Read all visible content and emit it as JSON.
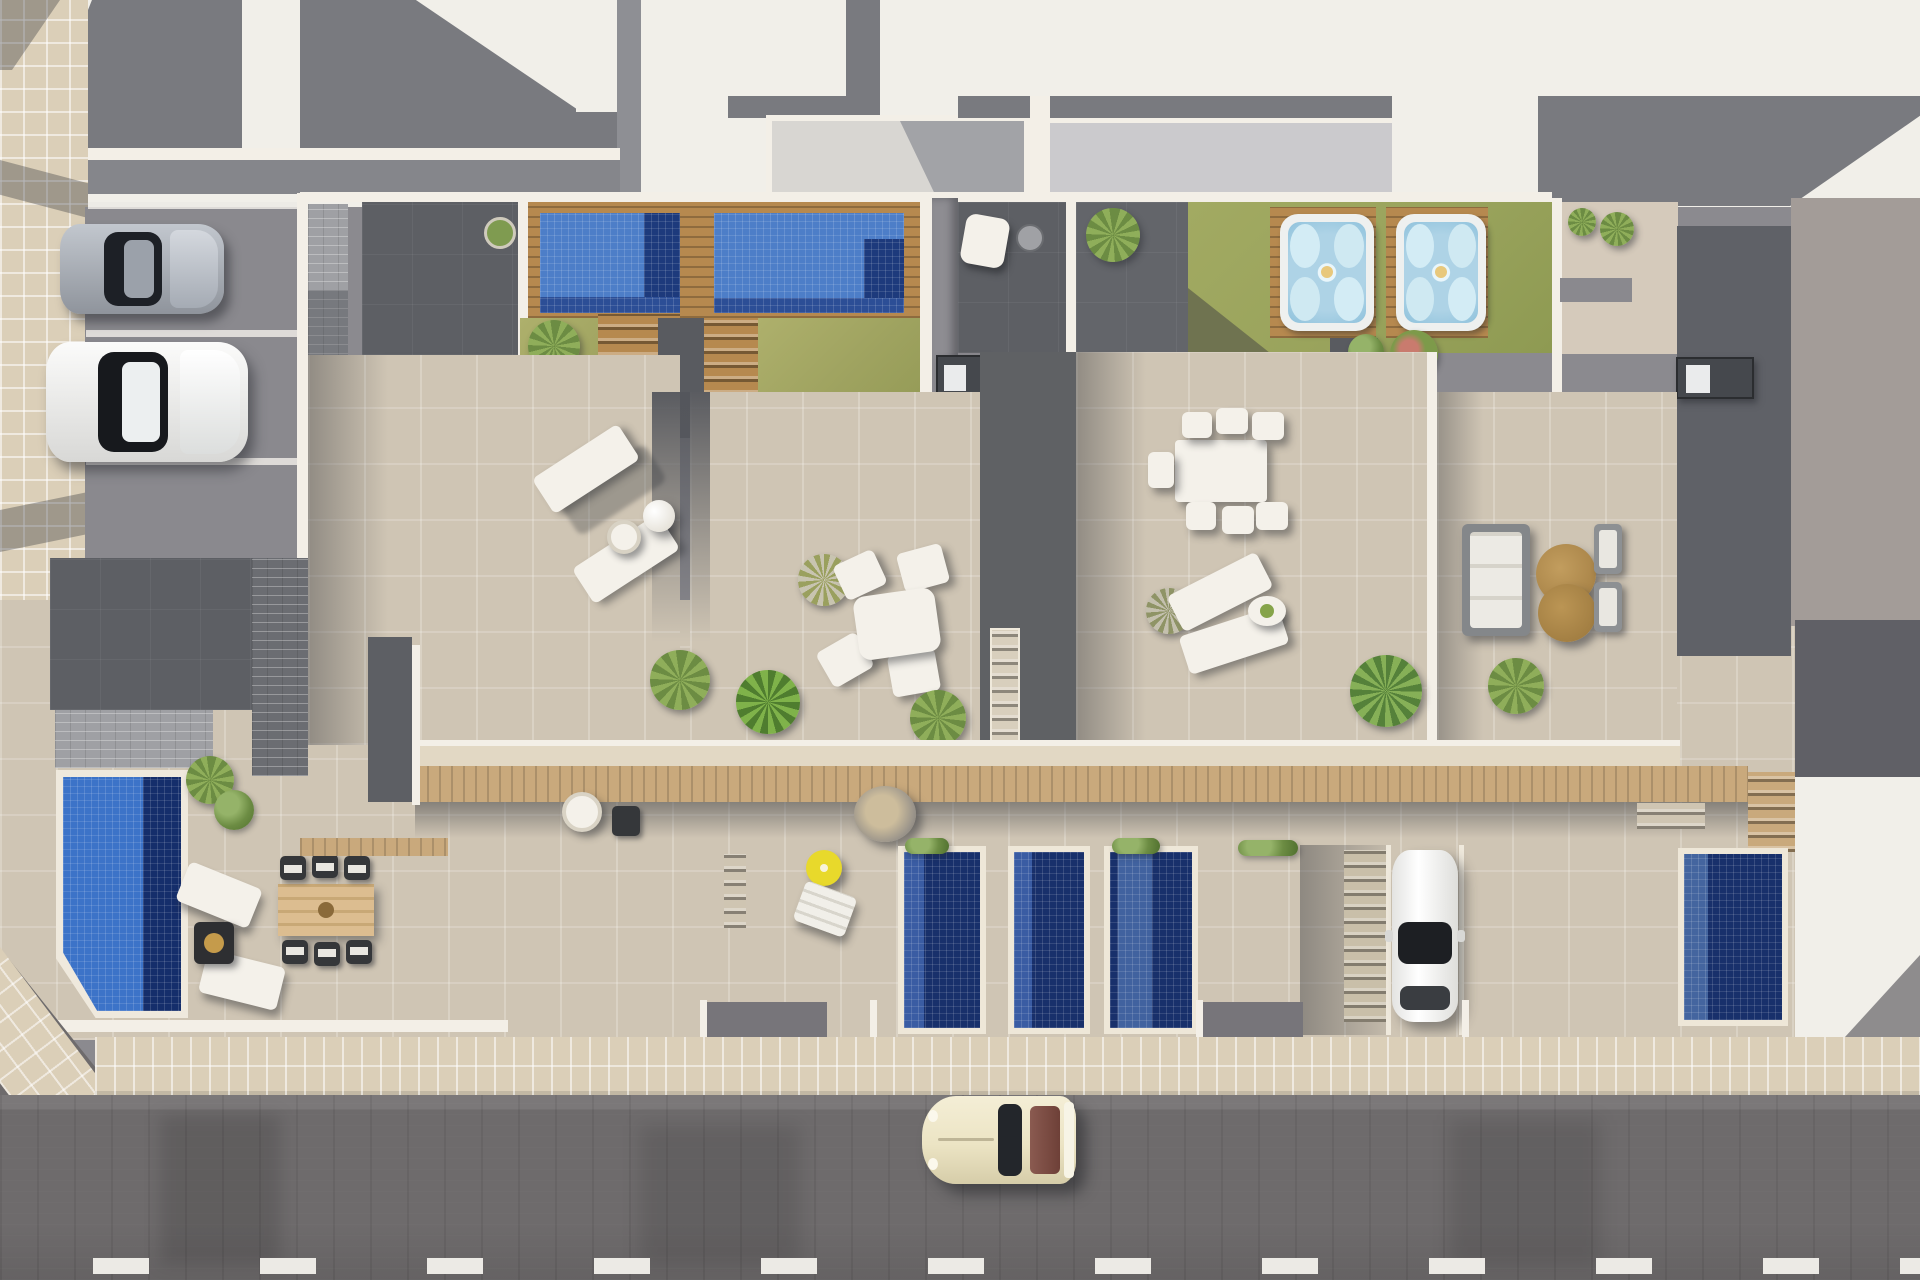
{
  "meta": {
    "type": "architectural-aerial-3d-render",
    "subject": "Top-down view of a row of modern townhouses with roof-terrace solariums, private pools, hot tubs, rear gardens, street-side parking and a road in the foreground",
    "canvas": {
      "width": 1920,
      "height": 1280
    },
    "visible_text": []
  },
  "palette": {
    "roof_white": "#f1efe9",
    "roof_shadow": "#797a7f",
    "panel_gray": "#d8d6d2",
    "concrete_mid": "#8b8a8f",
    "terrace_dark": "#5d5f64",
    "terrace_beige": "#cfc5b4",
    "wall_white": "#f3efe7",
    "band_beige": "#e2d8c4",
    "sidewalk_beige": "#dbcfb8",
    "street_gray": "#6e6b6c",
    "lane_white": "#eceae5",
    "pool_blue": "#4d7ec8",
    "pool_navy": "#1d3a7c",
    "pool_deep": "#18306b",
    "pool_bright": "#3c73c8",
    "lawn_green": "#a9ac68",
    "lawn_olive": "#99a35c",
    "wood": "#b6894f",
    "wood_light": "#c9a97c",
    "hot_tub_blue": "#aed3e6",
    "table_tan": "#b18c50",
    "parasol_yellow": "#e8d92b",
    "car_cream": "#ece4c4",
    "car_silver": "#a7aeb8",
    "car_white": "#f4f4f4",
    "plant_green": "#76984b"
  },
  "scene": {
    "roofs": {
      "upper_roof_count": 4,
      "shadow_shapes": "hard sun shadows cast to lower-left"
    },
    "roof_gardens": {
      "tiled_roof_pools": 2,
      "hot_tubs_on_wood_decks": 2,
      "lawns": 4,
      "dark_roof_patios": 3,
      "tree_planter_circle": 1,
      "outdoor_kitchen_counters": 7
    },
    "roof_terraces": [
      {
        "unit": 1,
        "furniture": [
          "sun-lounger",
          "sun-lounger",
          "side-table",
          "parasol-ball"
        ]
      },
      {
        "unit": 2,
        "furniture": [
          "dining-table",
          "chair",
          "chair",
          "chair",
          "chair",
          "fan-palm"
        ]
      },
      {
        "unit": 3,
        "furniture": [
          "dining-table",
          "six-chairs",
          "sun-lounger",
          "sun-lounger",
          "oval-table"
        ]
      },
      {
        "unit": 4,
        "furniture": [
          "garden-sofa",
          "round-coffee-table",
          "round-coffee-table",
          "armchair",
          "armchair"
        ]
      }
    ],
    "ground_level": {
      "narrow_plunge_pools": 4,
      "corner_garden_pool": 1,
      "yellow_parasol": 1,
      "hanging_chair": 1,
      "wood_pergola_walkway": true,
      "staircases": 5,
      "parked_white_car_driveway": 1,
      "corner_patio": [
        "sun-lounger",
        "sun-lounger",
        "fire-table",
        "wood-dining-table",
        "six-wicker-chairs"
      ]
    },
    "parking": {
      "bays": 3,
      "cars": [
        {
          "name": "silver-sports-car"
        },
        {
          "name": "white-hatchback"
        }
      ]
    },
    "street": {
      "sidewalk": "beige tile band with diagonal corner at lower left",
      "lane_dashes": 12,
      "vehicles": [
        {
          "name": "cream-classic-car",
          "heading": "left"
        }
      ]
    }
  }
}
